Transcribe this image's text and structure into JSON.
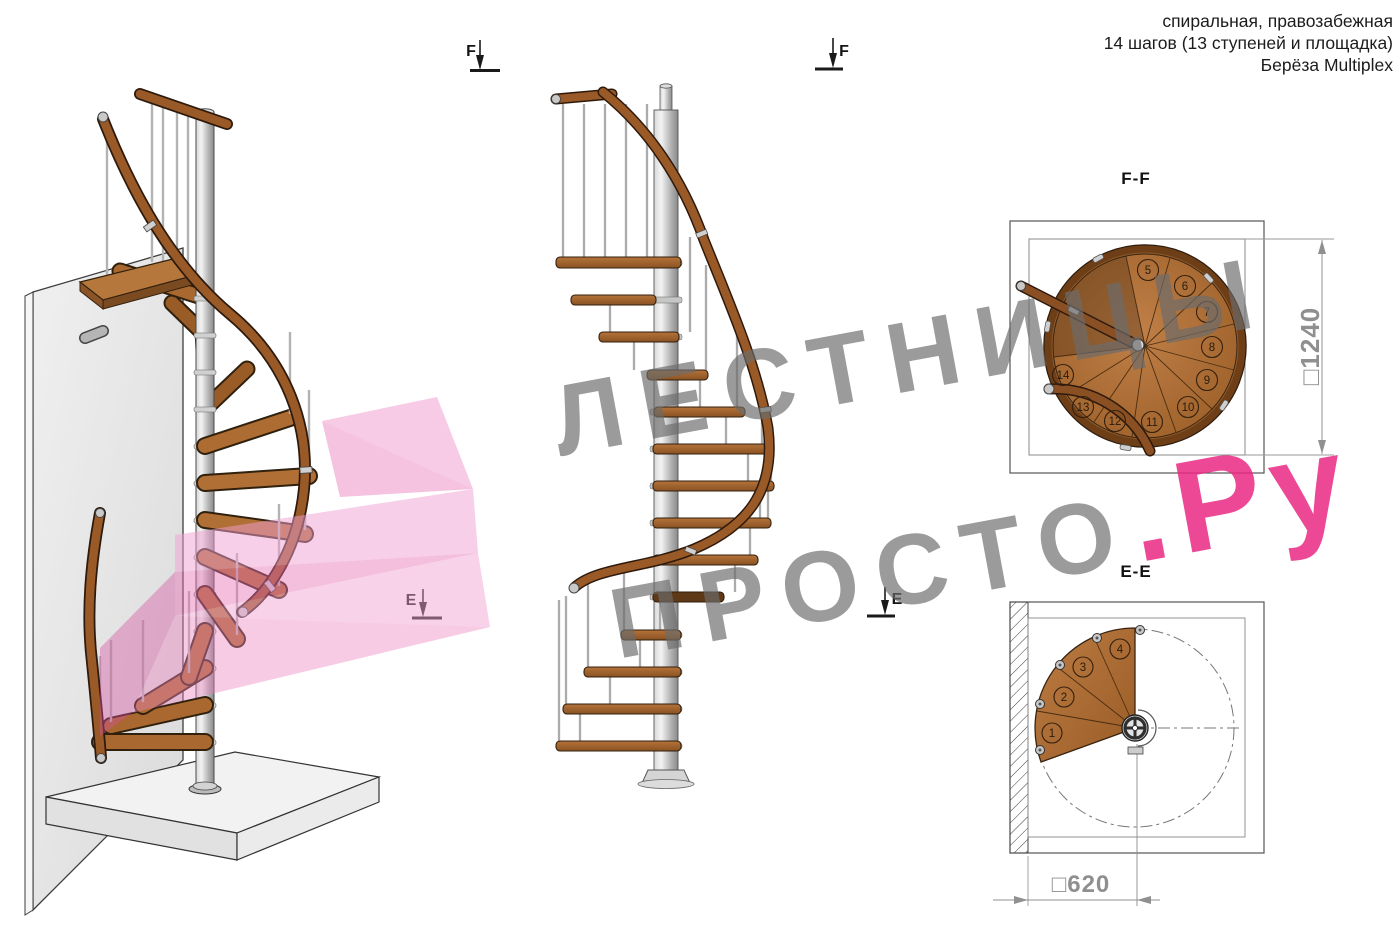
{
  "header": {
    "line1": "спиральная, правозабежная",
    "line2": "14 шагов (13 ступеней и площадка)",
    "line3": "Берёза Multiplex"
  },
  "watermark": {
    "line1": "ЛЕСТНИЦЫ",
    "line2_gray": "ПРОСТО",
    "line2_pink": ".Ру"
  },
  "views": {
    "ff": {
      "title": "F-F",
      "dimension": "□1240",
      "steps": [
        "5",
        "6",
        "7",
        "8",
        "9",
        "10",
        "11",
        "12",
        "13",
        "14"
      ]
    },
    "ee": {
      "title": "E-E",
      "dimension": "□620",
      "steps": [
        "1",
        "2",
        "3",
        "4"
      ]
    }
  },
  "markers": {
    "f_left": "F",
    "f_right": "F",
    "e_left": "E",
    "e_right": "E"
  },
  "colors": {
    "wood": "#a9682f",
    "handrail": "#9a5a28",
    "steel": "#c9c9c9",
    "line": "#2b2b2b",
    "dim_text": "#8f8f8f",
    "watermark_gray": "#9b9b9b",
    "watermark_pink": "#ee4d96",
    "overlay_pink": "#f2a7cf"
  }
}
